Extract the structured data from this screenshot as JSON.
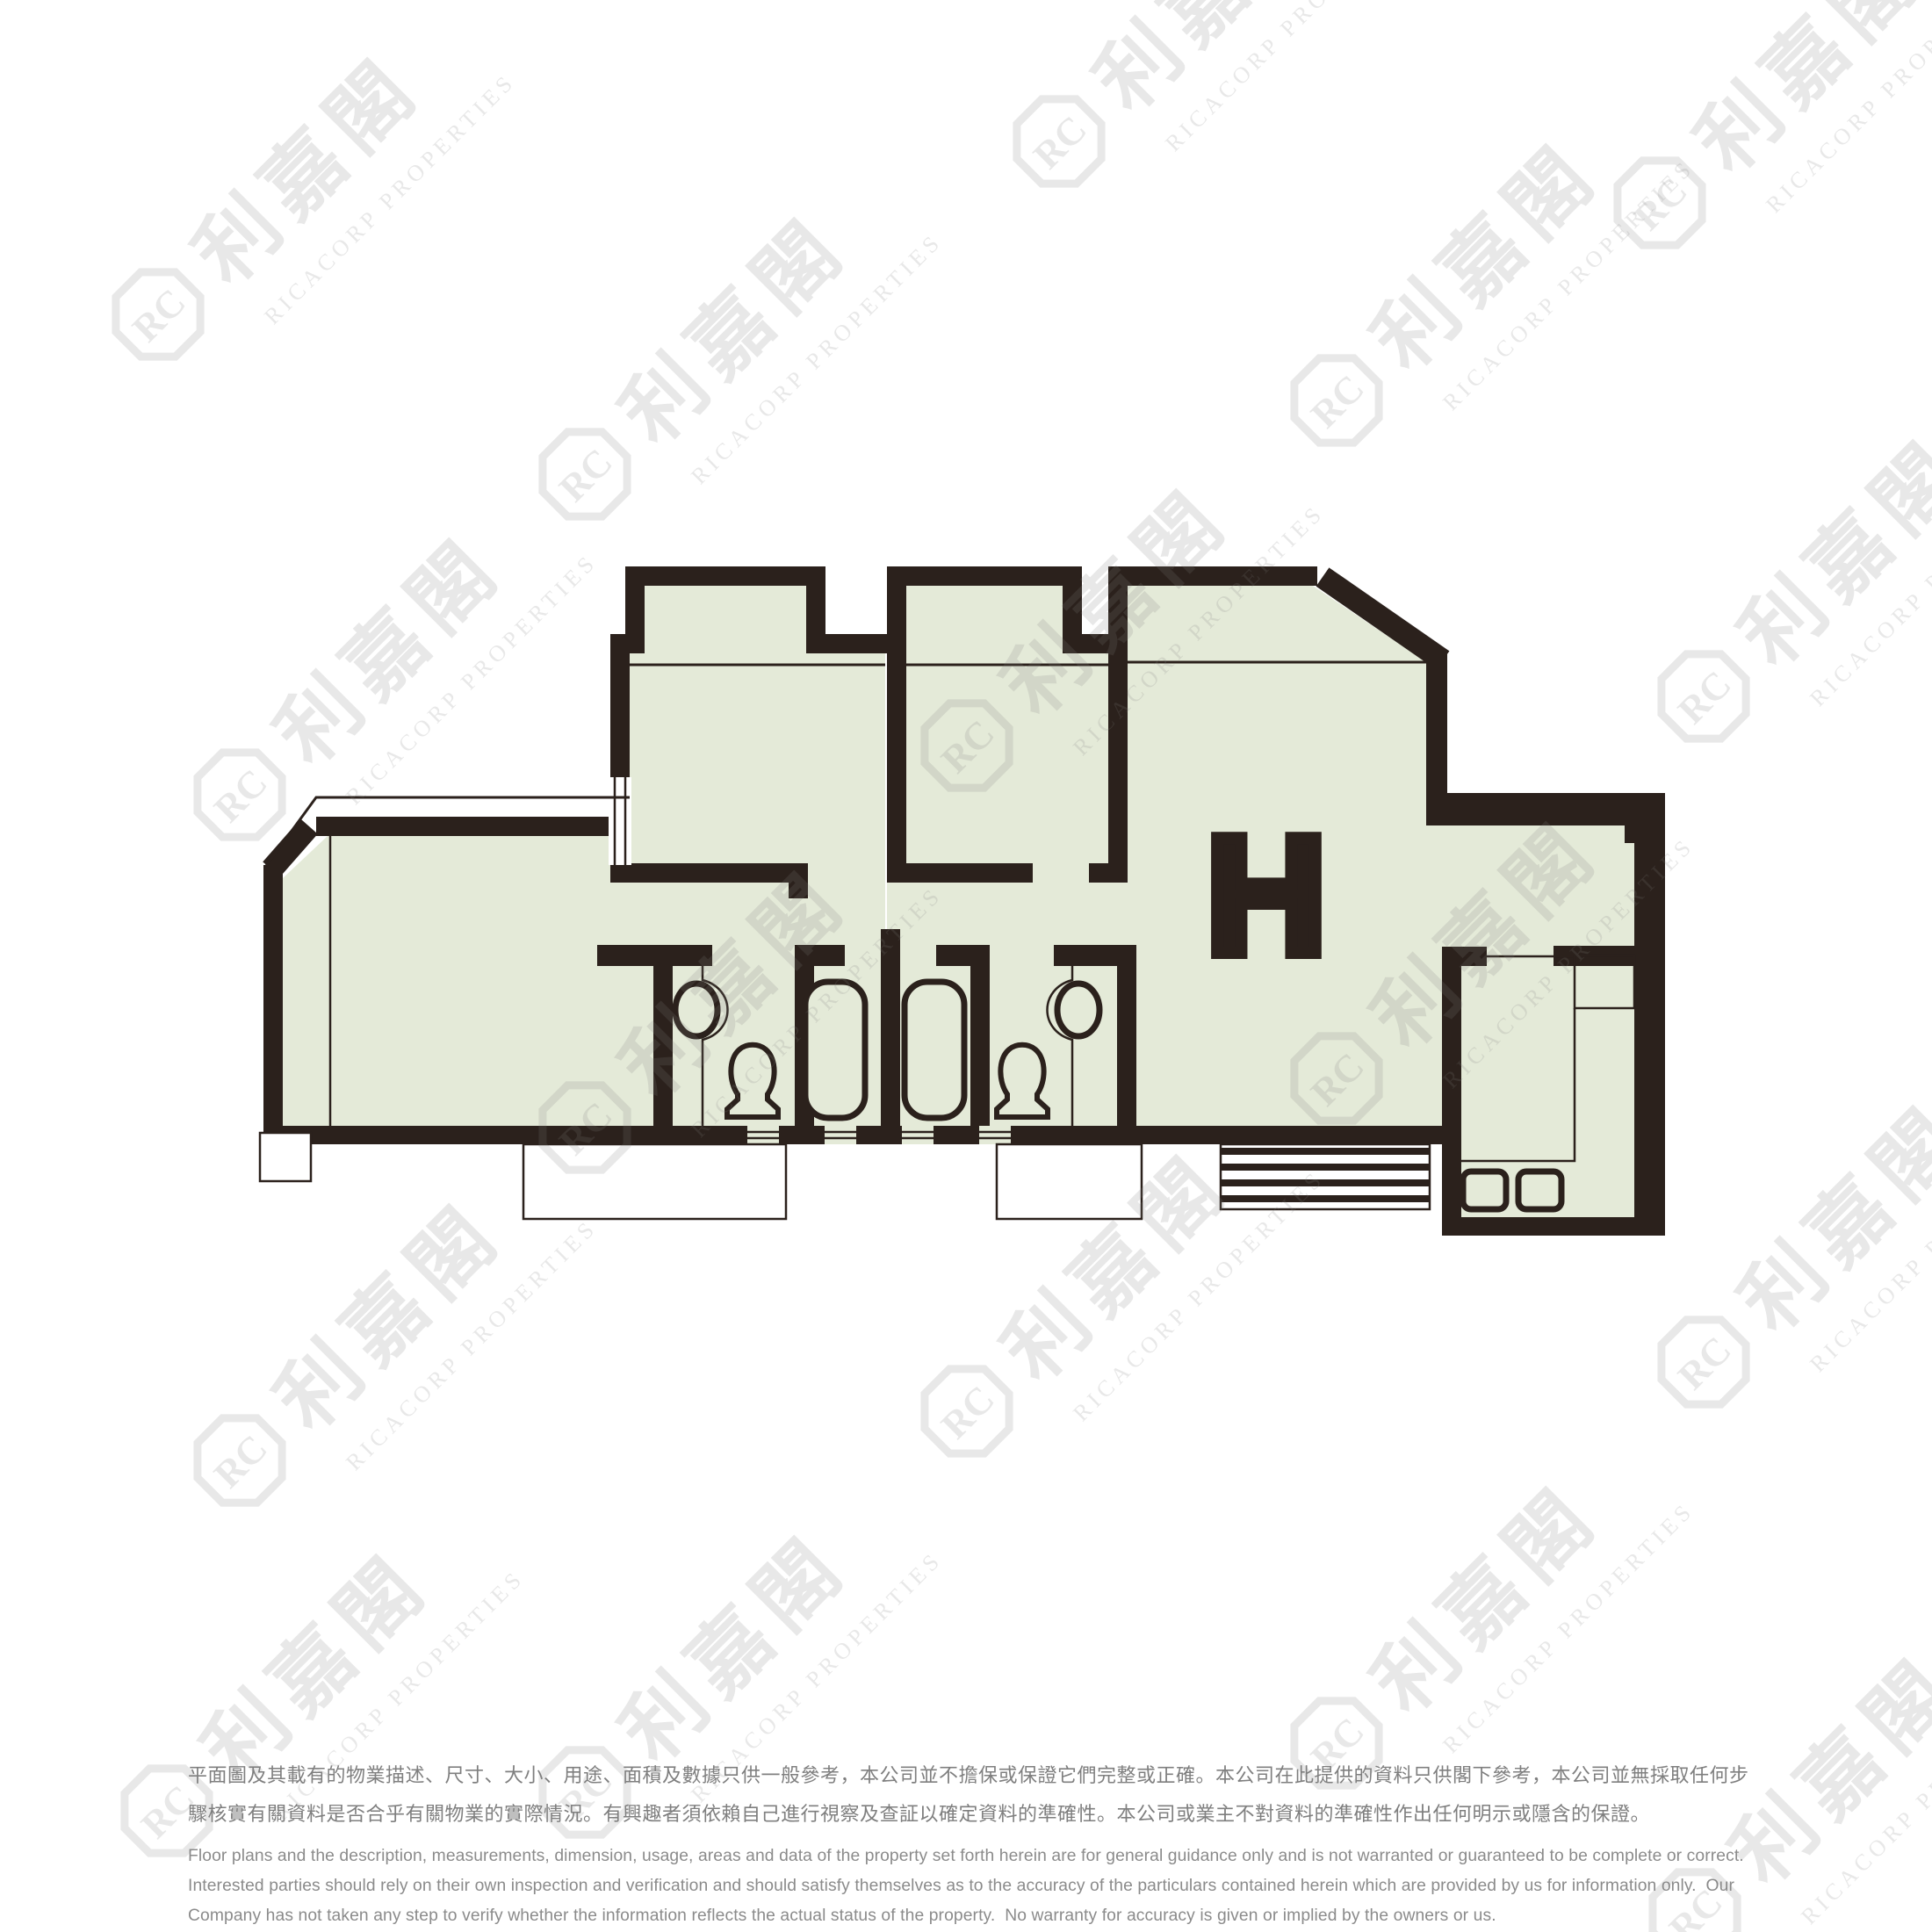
{
  "plan": {
    "unit_label": "H",
    "colors": {
      "wall": "#2b211c",
      "floor_fill": "#e4ead8",
      "watermark": "#e9e9e9",
      "disclaimer_chinese": "#7f7f7f",
      "disclaimer_english": "#8b8b8b"
    },
    "fixtures": [
      "wash-basin",
      "toilet",
      "bathtub",
      "bathtub",
      "toilet",
      "wash-basin",
      "kitchen-sink",
      "kitchen-sink",
      "louver-vent",
      "balcony-platform",
      "balcony-platform"
    ]
  },
  "watermark": {
    "chinese": "利嘉閣",
    "english": "RICACORP PROPERTIES",
    "monogram": "RC"
  },
  "disclaimer": {
    "chinese_lines": [
      "平面圖及其載有的物業描述、尺寸、大小、用途、面積及數據只供一般參考，本公司並不擔保或保證它們完整或正確。本公司在此提供的資料只供閣下參考，本公司並無採取任何步",
      "驟核實有關資料是否合乎有關物業的實際情況。有興趣者須依賴自己進行視察及查証以確定資料的準確性。本公司或業主不對資料的準確性作出任何明示或隱含的保證。"
    ],
    "english_lines": [
      "Floor plans and the description, measurements, dimension, usage, areas and data of the property set forth herein are for general guidance only and is not warranted or guaranteed to be complete or correct.",
      "Interested parties should rely on their own inspection and verification and should satisfy themselves as to the accuracy of the particulars contained herein which are provided by us for information only.  Our",
      "Company has not taken any step to verify whether the information reflects the actual status of the property.  No warranty for accuracy is given or implied by the owners or us."
    ]
  }
}
